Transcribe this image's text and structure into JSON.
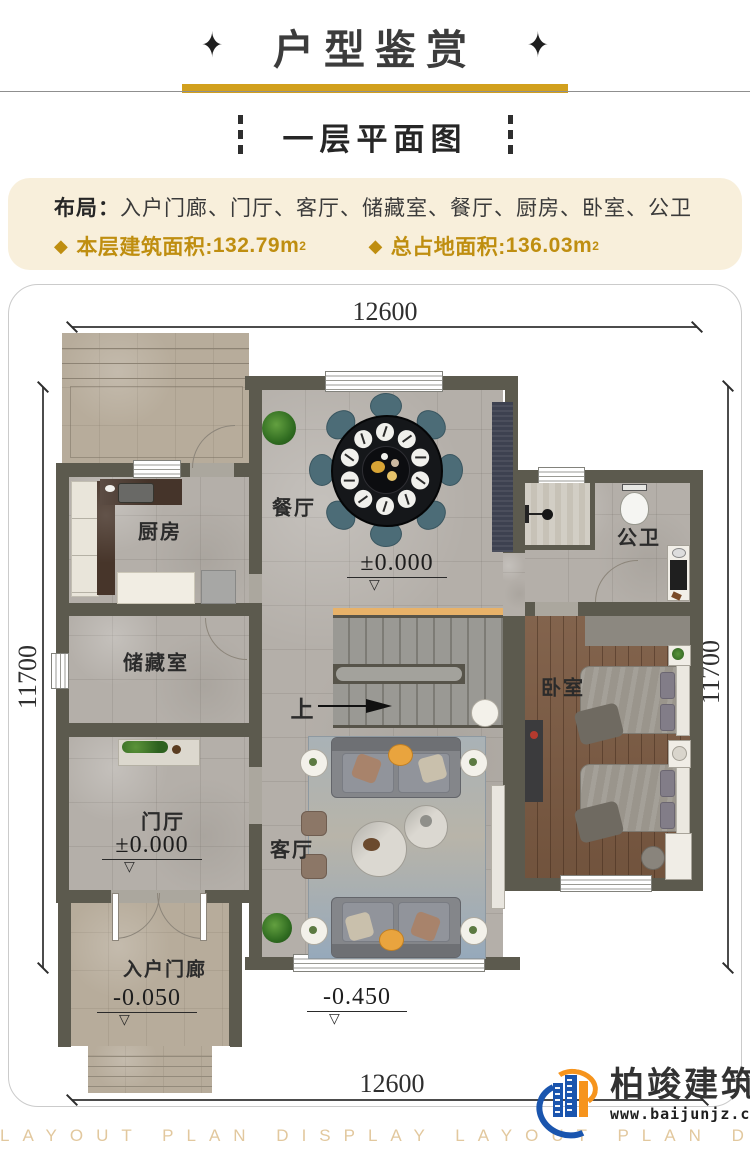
{
  "header": {
    "ornament": "✦",
    "title": "户型鉴赏",
    "subtitle": "一层平面图"
  },
  "info": {
    "layout_label": "布局：",
    "layout_value": "入户门廊、门厅、客厅、储藏室、餐厅、厨房、卧室、公卫",
    "bullet": "◆",
    "stat1_label": "本层建筑面积:",
    "stat1_value": "132.79m",
    "stat1_sup": "2",
    "stat2_label": "总占地面积:",
    "stat2_value": "136.03m",
    "stat2_sup": "2"
  },
  "plan": {
    "dim_top": "12600",
    "dim_bottom": "12600",
    "dim_left": "11700",
    "dim_right": "11700",
    "rooms": {
      "kitchen": "厨房",
      "dining": "餐厅",
      "bath": "公卫",
      "storage": "储藏室",
      "bedroom": "卧室",
      "foyer": "门厅",
      "living": "客厅",
      "porch": "入户门廊"
    },
    "elevations": {
      "dining": "±0.000",
      "foyer": "±0.000",
      "porch": "-0.050",
      "outside": "-0.450"
    },
    "triangle": "▽",
    "stairs_up": "上"
  },
  "footer": {
    "brand": "柏竣建筑",
    "website": "www.baijunjz.com",
    "watermark": "LAYOUT PLAN DISPLAY LAYOUT PLAN DISPLAY"
  },
  "colors": {
    "gold": "#bf8e10",
    "accent_bar": "#d2a01d",
    "wall": "#5c5a4e",
    "info_bg": "#f8efdb",
    "logo_blue": "#1a55ae",
    "logo_orange": "#f6941d"
  }
}
